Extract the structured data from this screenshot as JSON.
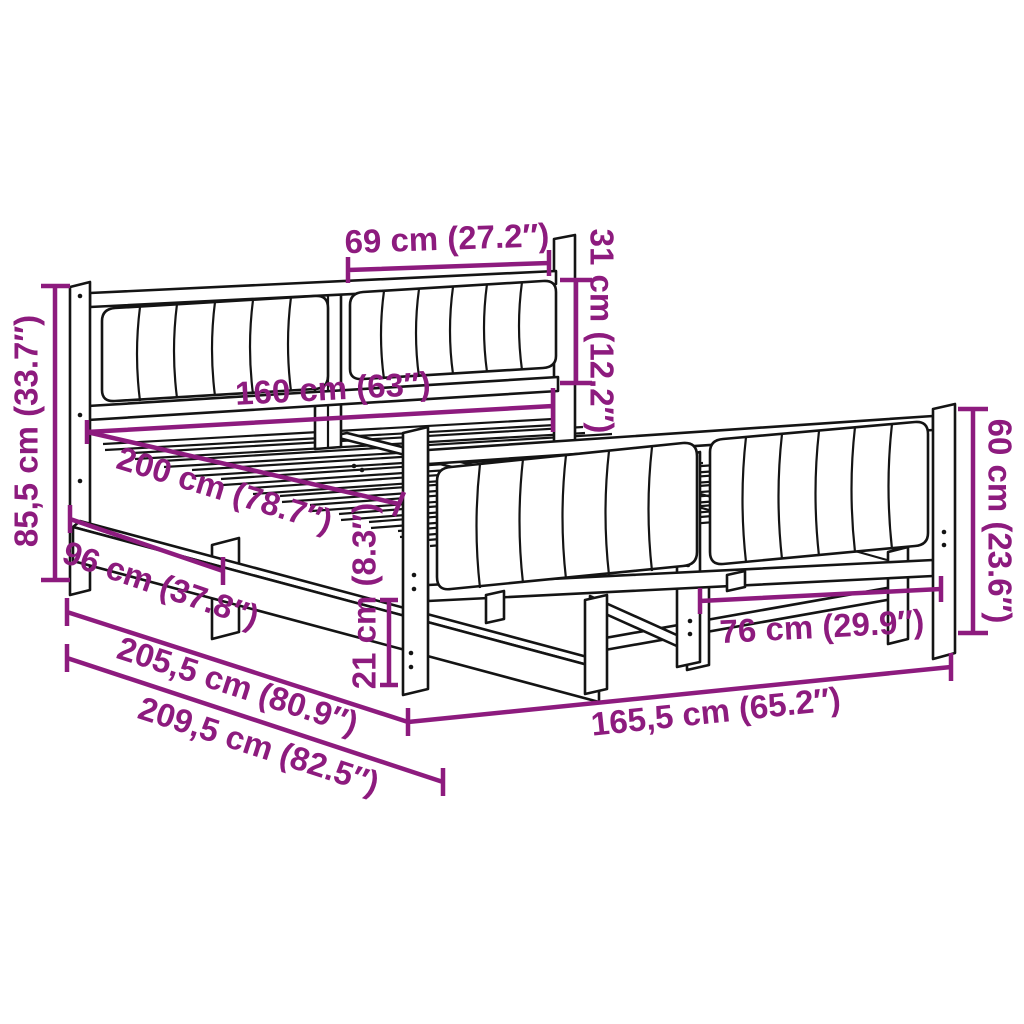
{
  "image": {
    "type": "product-dimension-diagram",
    "subject": "bed frame with upholstered headboard and footboard, slatted base"
  },
  "colors": {
    "dimension_accent": "#8D1B7E",
    "line_art": "#141414",
    "background": "#FFFFFF"
  },
  "dimensions": {
    "headboard_cushion_width": "69 cm (27.2″)",
    "headboard_cushion_height": "31 cm (12.2″)",
    "mattress_width": "160 cm (63″)",
    "mattress_length": "200 cm (78.7″)",
    "headboard_height": "85,5 cm (33.7″)",
    "headboard_to_center_leg": "96 cm (37.8″)",
    "under_bed_clearance": "21 cm (8.3″)",
    "frame_length": "205,5 cm (80.9″)",
    "overall_length": "209,5 cm (82.5″)",
    "overall_width": "165,5 cm (65.2″)",
    "footboard_cushion_width": "76 cm (29.9″)",
    "footboard_height": "60 cm (23.6″)"
  }
}
